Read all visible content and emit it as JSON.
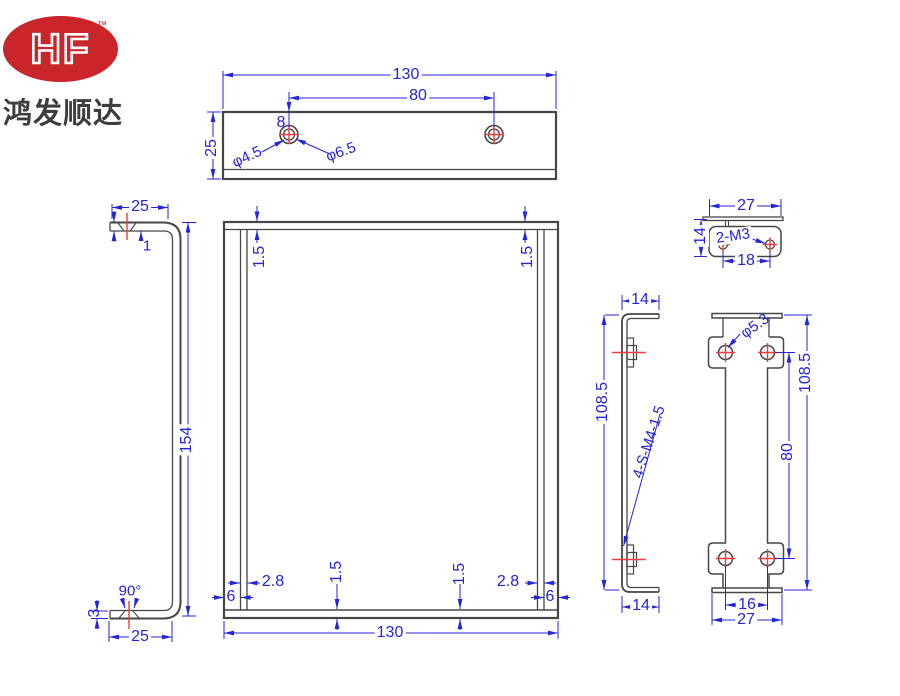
{
  "company": {
    "logo_text": "HF",
    "trademark": "™",
    "name": "鸿发顺达"
  },
  "colors": {
    "dimension": "#2424d8",
    "outline": "#464646",
    "centerline": "#f23c3c",
    "logo": "#c9252b"
  },
  "dims": {
    "top": {
      "width": "130",
      "hole_spacing": "80",
      "depth": "25",
      "hole_offset": "8",
      "hole_dia": "φ4.5",
      "csk_dia": "φ6.5"
    },
    "left": {
      "flange_top": "25",
      "csk_land": "1",
      "height": "154",
      "csk_angle": "90°",
      "thickness": "3",
      "flange_bottom": "25"
    },
    "front": {
      "wall_top_left": "1.5",
      "wall_top_right": "1.5",
      "rib_left": "2.8",
      "rib_right": "2.8",
      "edge_left": "6",
      "edge_right": "6",
      "floor_left": "1.5",
      "floor_right": "1.5",
      "width": "130"
    },
    "side": {
      "flange_top": "14",
      "height": "108.5",
      "thread_note": "4-S-M4-1.5",
      "flange_bottom": "14"
    },
    "bracket": {
      "hole_dia": "φ5.3",
      "height": "108.5",
      "hole_span": "80",
      "hole_pitch": "16",
      "width": "27"
    },
    "clip": {
      "width": "27",
      "height": "14",
      "thread_note": "2-M3",
      "hole_pitch": "18"
    }
  }
}
